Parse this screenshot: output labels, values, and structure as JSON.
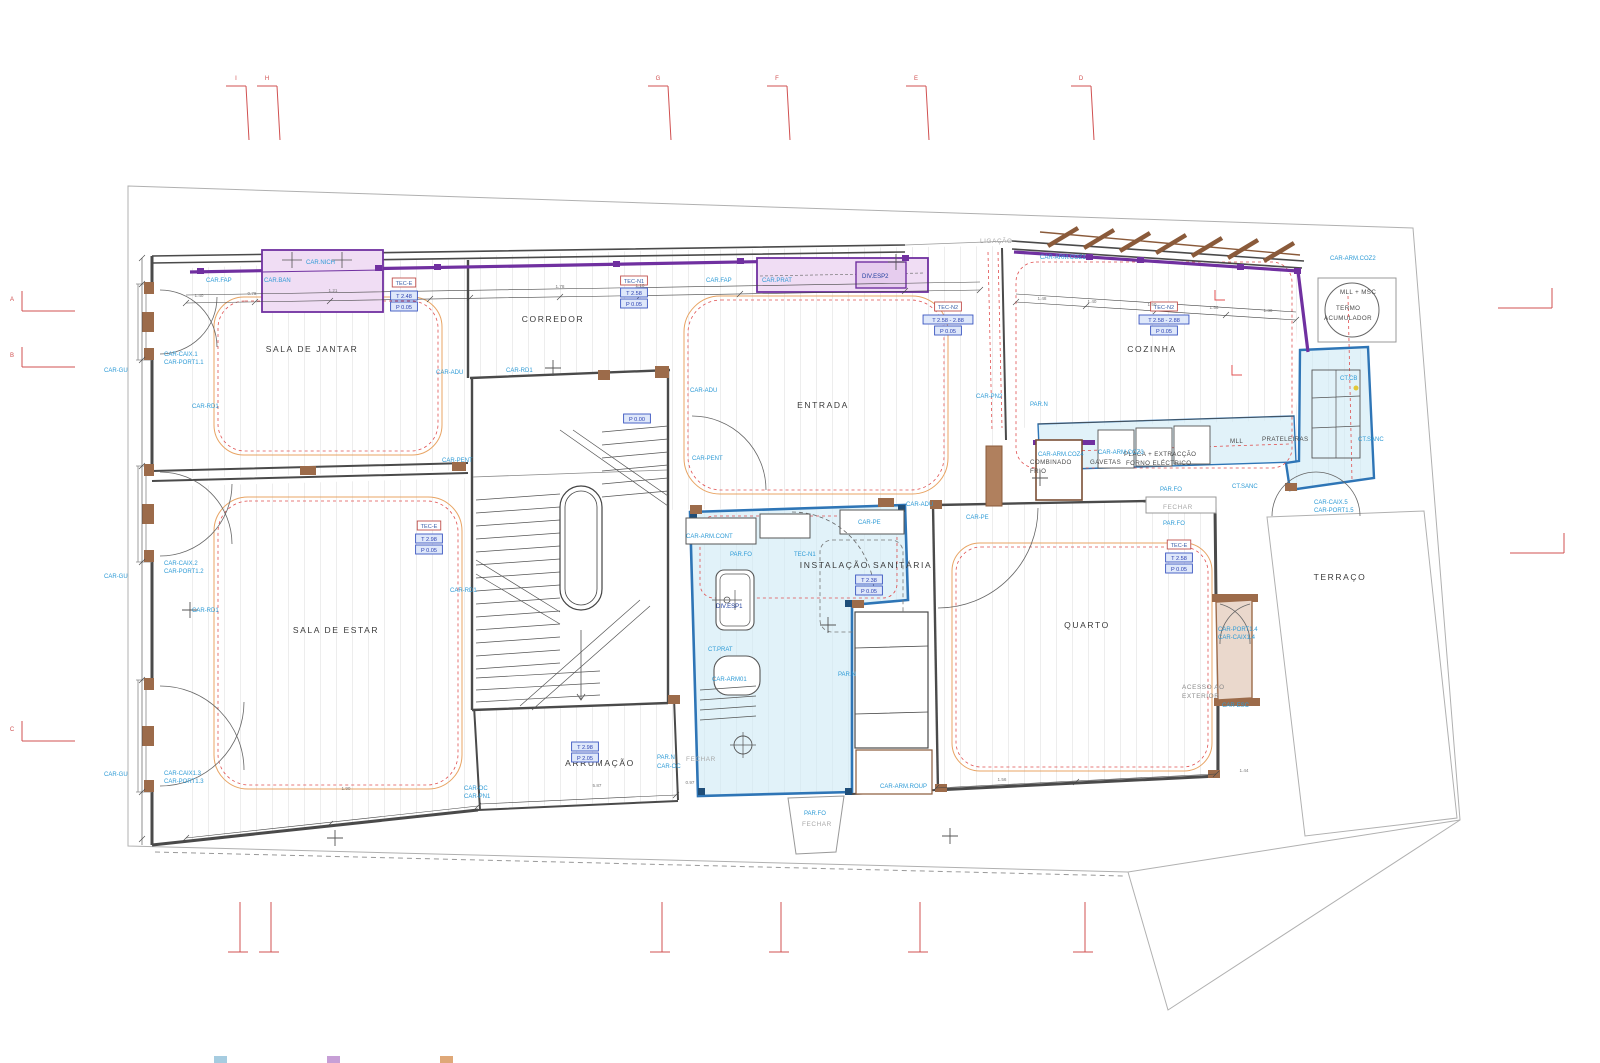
{
  "drawing_labels": {
    "rooms": [
      {
        "t": "SALA DE JANTAR",
        "x": 312,
        "y": 352
      },
      {
        "t": "CORREDOR",
        "x": 553,
        "y": 322
      },
      {
        "t": "ENTRADA",
        "x": 823,
        "y": 408
      },
      {
        "t": "COZINHA",
        "x": 1152,
        "y": 352
      },
      {
        "t": "SALA DE ESTAR",
        "x": 336,
        "y": 633
      },
      {
        "t": "INSTALAÇÃO SANITÁRIA",
        "x": 866,
        "y": 568
      },
      {
        "t": "QUARTO",
        "x": 1087,
        "y": 628
      },
      {
        "t": "ARRUMAÇÃO",
        "x": 600,
        "y": 766
      },
      {
        "t": "TERRAÇO",
        "x": 1340,
        "y": 580
      }
    ],
    "annotations_small": [
      {
        "t": "TERMO",
        "x": 1336,
        "y": 310
      },
      {
        "t": "ACUMULADOR",
        "x": 1324,
        "y": 320
      },
      {
        "t": "MLL + MSC",
        "x": 1340,
        "y": 294
      },
      {
        "t": "COMBINADO",
        "x": 1030,
        "y": 464
      },
      {
        "t": "FRIO",
        "x": 1030,
        "y": 473
      },
      {
        "t": "GAVETAS",
        "x": 1090,
        "y": 464
      },
      {
        "t": "PLACA + EXTRACÇÃO",
        "x": 1124,
        "y": 456
      },
      {
        "t": "FORNO ELÉCTRICO",
        "x": 1126,
        "y": 465
      },
      {
        "t": "MLL",
        "x": 1230,
        "y": 443
      },
      {
        "t": "PRATELEIRAS",
        "x": 1262,
        "y": 441
      }
    ],
    "grey_notes": [
      {
        "t": "LIGAÇÃO",
        "x": 980,
        "y": 243
      },
      {
        "t": "FECHAR",
        "x": 1163,
        "y": 509
      },
      {
        "t": "FECHAR",
        "x": 686,
        "y": 761
      },
      {
        "t": "FECHAR",
        "x": 802,
        "y": 826
      },
      {
        "t": "ACESSO AO",
        "x": 1182,
        "y": 689,
        "d": 1
      },
      {
        "t": "EXTERIOR",
        "x": 1182,
        "y": 698,
        "d": 1
      }
    ],
    "element_labels": [
      {
        "t": "CAR.FAP",
        "x": 206,
        "y": 282
      },
      {
        "t": "CAR.NICH",
        "x": 306,
        "y": 264
      },
      {
        "t": "CAR.BAN",
        "x": 264,
        "y": 282
      },
      {
        "t": "CAR.FAP",
        "x": 706,
        "y": 282
      },
      {
        "t": "CAR.PRAT",
        "x": 762,
        "y": 282
      },
      {
        "t": "DIV.ESP2",
        "x": 862,
        "y": 278,
        "d": 1
      },
      {
        "t": "CAR-ARM.COZ1",
        "x": 1040,
        "y": 259
      },
      {
        "t": "CAR-ARM.COZ2",
        "x": 1330,
        "y": 260
      },
      {
        "t": "CAR-GU",
        "x": 104,
        "y": 372
      },
      {
        "t": "CAR-GU",
        "x": 104,
        "y": 578
      },
      {
        "t": "CAR-GU",
        "x": 104,
        "y": 776
      },
      {
        "t": "CAR-CAIX.1",
        "x": 164,
        "y": 356
      },
      {
        "t": "CAR-PORT1.1",
        "x": 164,
        "y": 364
      },
      {
        "t": "CAR-CAIX.2",
        "x": 164,
        "y": 565
      },
      {
        "t": "CAR-PORT1.2",
        "x": 164,
        "y": 573
      },
      {
        "t": "CAR-CAIX1.3",
        "x": 164,
        "y": 775
      },
      {
        "t": "CAR-PORT1.3",
        "x": 164,
        "y": 783
      },
      {
        "t": "CAR-RD1",
        "x": 192,
        "y": 408
      },
      {
        "t": "CAR-RD1",
        "x": 506,
        "y": 372
      },
      {
        "t": "CAR-RD1",
        "x": 192,
        "y": 612
      },
      {
        "t": "CAR-RD1",
        "x": 450,
        "y": 592
      },
      {
        "t": "CAR-ADU",
        "x": 436,
        "y": 374
      },
      {
        "t": "CAR-ADU",
        "x": 690,
        "y": 392
      },
      {
        "t": "CAR-ADU",
        "x": 906,
        "y": 506
      },
      {
        "t": "CAR-PENT",
        "x": 442,
        "y": 462
      },
      {
        "t": "CAR-PENT",
        "x": 692,
        "y": 460
      },
      {
        "t": "CAR-PN2",
        "x": 976,
        "y": 398
      },
      {
        "t": "PAR.N",
        "x": 1030,
        "y": 406
      },
      {
        "t": "CAR-PE",
        "x": 858,
        "y": 524
      },
      {
        "t": "CAR-PE",
        "x": 966,
        "y": 519
      },
      {
        "t": "CAR-ARM.CONT",
        "x": 686,
        "y": 538
      },
      {
        "t": "PAR.FO",
        "x": 730,
        "y": 556
      },
      {
        "t": "TEC-N1",
        "x": 794,
        "y": 556
      },
      {
        "t": "DIV.ESP1",
        "x": 716,
        "y": 608,
        "d": 1
      },
      {
        "t": "CT.PRAT",
        "x": 708,
        "y": 651
      },
      {
        "t": "CAR-ARM01",
        "x": 712,
        "y": 681
      },
      {
        "t": "PAR.N",
        "x": 838,
        "y": 676
      },
      {
        "t": "PAR.N",
        "x": 657,
        "y": 759
      },
      {
        "t": "CAR-OC",
        "x": 657,
        "y": 768
      },
      {
        "t": "CAR-OC",
        "x": 464,
        "y": 790
      },
      {
        "t": "CAR-PN1",
        "x": 464,
        "y": 798
      },
      {
        "t": "CAR-ARM.ROUP",
        "x": 880,
        "y": 788
      },
      {
        "t": "PAR.FO",
        "x": 804,
        "y": 815
      },
      {
        "t": "CAR-ARM.COZ4",
        "x": 1038,
        "y": 456
      },
      {
        "t": "CAR-ARM.COZ3",
        "x": 1098,
        "y": 454
      },
      {
        "t": "PAR.FO",
        "x": 1160,
        "y": 491
      },
      {
        "t": "CT.SANC",
        "x": 1232,
        "y": 488
      },
      {
        "t": "PAR.FO",
        "x": 1163,
        "y": 525
      },
      {
        "t": "CT.CB",
        "x": 1340,
        "y": 380
      },
      {
        "t": "CT.SANC",
        "x": 1358,
        "y": 441
      },
      {
        "t": "CAR-CAIX.5",
        "x": 1314,
        "y": 504
      },
      {
        "t": "CAR-PORT1.5",
        "x": 1314,
        "y": 512
      },
      {
        "t": "CAR-PORT1.4",
        "x": 1218,
        "y": 631
      },
      {
        "t": "CAR-CAIX1.4",
        "x": 1218,
        "y": 639
      },
      {
        "t": "CAR-ESC",
        "x": 1222,
        "y": 707
      }
    ],
    "level_boxes": [
      {
        "t": "T 2.48",
        "x": 404,
        "y": 298
      },
      {
        "t": "P 0.05",
        "x": 404,
        "y": 309
      },
      {
        "t": "T 2.58",
        "x": 634,
        "y": 295
      },
      {
        "t": "P 0.05",
        "x": 634,
        "y": 306
      },
      {
        "t": "T 2.58 - 2.88",
        "x": 948,
        "y": 322
      },
      {
        "t": "P 0.05",
        "x": 948,
        "y": 333
      },
      {
        "t": "T 2.58 - 2.88",
        "x": 1164,
        "y": 322
      },
      {
        "t": "P 0.05",
        "x": 1164,
        "y": 333
      },
      {
        "t": "P 0.00",
        "x": 637,
        "y": 421
      },
      {
        "t": "T 2.98",
        "x": 429,
        "y": 541
      },
      {
        "t": "P 0.05",
        "x": 429,
        "y": 552
      },
      {
        "t": "T 2.38",
        "x": 869,
        "y": 582
      },
      {
        "t": "P 0.05",
        "x": 869,
        "y": 593
      },
      {
        "t": "T 2.58",
        "x": 1179,
        "y": 560
      },
      {
        "t": "P 0.05",
        "x": 1179,
        "y": 571
      },
      {
        "t": "T 2.98",
        "x": 585,
        "y": 749
      },
      {
        "t": "P 2.05",
        "x": 585,
        "y": 760
      }
    ],
    "tec_boxes": [
      {
        "t": "TEC-E",
        "x": 404,
        "y": 285
      },
      {
        "t": "TEC-N1",
        "x": 634,
        "y": 283
      },
      {
        "t": "TEC-N2",
        "x": 948,
        "y": 309
      },
      {
        "t": "TEC-N2",
        "x": 1164,
        "y": 309
      },
      {
        "t": "TEC-E",
        "x": 429,
        "y": 528
      },
      {
        "t": "TEC-E",
        "x": 1179,
        "y": 547
      }
    ],
    "dimensions": [
      {
        "t": "1.40",
        "x": 199,
        "y": 297
      },
      {
        "t": "0.78",
        "x": 252,
        "y": 295
      },
      {
        "t": "1.21",
        "x": 333,
        "y": 292
      },
      {
        "t": "1.78",
        "x": 560,
        "y": 288
      },
      {
        "t": "1.10",
        "x": 640,
        "y": 287
      },
      {
        "t": "1.48",
        "x": 1042,
        "y": 300
      },
      {
        "t": "1.40",
        "x": 1092,
        "y": 303
      },
      {
        "t": "1.50",
        "x": 1152,
        "y": 306
      },
      {
        "t": "1.56",
        "x": 1214,
        "y": 309
      },
      {
        "t": "1.30",
        "x": 1268,
        "y": 312
      },
      {
        "t": "1.90",
        "x": 346,
        "y": 790
      },
      {
        "t": "5.87",
        "x": 597,
        "y": 787
      },
      {
        "t": "0.97",
        "x": 690,
        "y": 784
      },
      {
        "t": "1.56",
        "x": 1002,
        "y": 781
      },
      {
        "t": "1.44",
        "x": 1244,
        "y": 772
      }
    ],
    "grid": {
      "top": [
        {
          "l": "I",
          "x": 240
        },
        {
          "l": "H",
          "x": 271
        },
        {
          "l": "G",
          "x": 662
        },
        {
          "l": "F",
          "x": 781
        },
        {
          "l": "E",
          "x": 920
        },
        {
          "l": "D",
          "x": 1085
        }
      ],
      "left": [
        {
          "l": "A",
          "y": 297
        },
        {
          "l": "B",
          "y": 353
        },
        {
          "l": "C",
          "y": 727
        }
      ],
      "bottom_x": [
        240,
        271,
        662,
        781,
        920,
        1085
      ],
      "right": [
        {
          "x": 1500,
          "y": 308
        },
        {
          "x": 1512,
          "y": 553
        }
      ]
    },
    "legend_swatches": [
      {
        "color": "#A6CCE0",
        "x": 214
      },
      {
        "color": "#C79FD6",
        "x": 327
      },
      {
        "color": "#DFA878",
        "x": 440
      }
    ]
  },
  "colors": {
    "label_cyan": "#2E9BD6",
    "label_navy": "#1F3F9E",
    "room_text": "#3A3A3A",
    "purple": "#7030A0",
    "lavender_fill": "#F0DDF4",
    "blue_wall": "#2E75B6",
    "blue_fill": "#CDE9F5",
    "brown": "#9C6B4A",
    "ceiling_orange": "#E8A464",
    "red_dashed": "#E05050",
    "grid_red": "#D05050",
    "wall": "#4A4A4A",
    "hatch": "#CCCCCC"
  }
}
